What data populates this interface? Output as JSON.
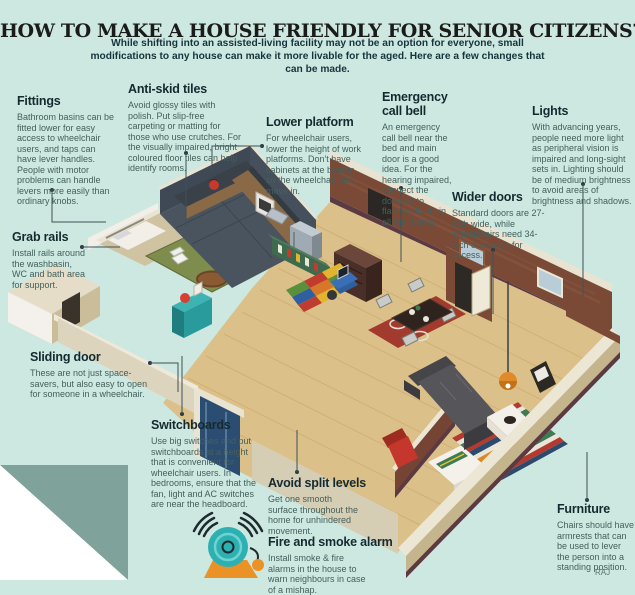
{
  "header": {
    "title": "HOW TO MAKE A HOUSE FRIENDLY FOR SENIOR CITIZENS?",
    "subtitle": "While shifting into an assisted-living facility may not be an option for everyone, small modifications to any house can make it more livable for the aged. Here are a few changes that can be made."
  },
  "annotations": [
    {
      "id": "fittings",
      "title": "Fittings",
      "body": "Bathroom basins can be fitted lower for easy access to wheelchair users, and taps can have lever handles. People with motor problems can handle levers more easily than ordinary knobs."
    },
    {
      "id": "anti-skid-tiles",
      "title": "Anti-skid tiles",
      "body": "Avoid glossy tiles with polish. Put slip-free carpeting or matting for those who use crutches. For the visually impaired, bright coloured floor tiles can help identify rooms."
    },
    {
      "id": "lower-platform",
      "title": "Lower platform",
      "body": "For wheelchair users, lower the height of work platforms. Don't have cabinets at the bottom, so the wheelchair can move in."
    },
    {
      "id": "emergency-call-bell",
      "title": "Emergency call bell",
      "body": "An emergency call bell near the bed and main door is a good idea. For the hearing impaired, connect the doorbell to flashing lights in all the rooms."
    },
    {
      "id": "lights",
      "title": "Lights",
      "body": "With advancing years, people need more light as peripheral vision is impaired and long-sight sets in. Lighting should be of medium brightness to avoid areas of brightness and shadows."
    },
    {
      "id": "wider-doors",
      "title": "Wider doors",
      "body": "Standard doors are 27-inch wide, while wheelchairs need 34-inch doorways for access."
    },
    {
      "id": "grab-rails",
      "title": "Grab rails",
      "body": "Install rails around the washbasin, WC and bath area for support."
    },
    {
      "id": "sliding-door",
      "title": "Sliding door",
      "body": "These are not just space-savers, but also easy to open for someone in a wheelchair."
    },
    {
      "id": "switchboards",
      "title": "Switchboards",
      "body": "Use big switches and put switchboards at a height that is convenient for wheelchair users. In bedrooms, ensure that the fan, light and AC switches are near the headboard."
    },
    {
      "id": "avoid-split-levels",
      "title": "Avoid split levels",
      "body": "Get one smooth surface throughout the home for unhindered movement."
    },
    {
      "id": "fire-and-smoke-alarm",
      "title": "Fire and smoke alarm",
      "body": "Install smoke & fire alarms in the house to warn neighbours in case of a mishap."
    },
    {
      "id": "furniture",
      "title": "Furniture",
      "body": "Chairs should have armrests that can be used to lever the person into a standing position."
    }
  ],
  "credit": "RAJ",
  "icons": {
    "alarm_bell": "alarm-bell-icon"
  },
  "colors": {
    "background": "#cde8e0",
    "heading_text": "#152a30",
    "body_text": "#44605c",
    "bell_teal": "#2cb0b2",
    "bell_orange": "#ea9226",
    "wall_cream": "#ece6d4",
    "brick": "#7b4a37",
    "wood_floor": "#dcc089",
    "bathroom_green": "#7e8c4d",
    "kitchen_slate": "#49545f",
    "corner_fold": "#7fa29b"
  }
}
